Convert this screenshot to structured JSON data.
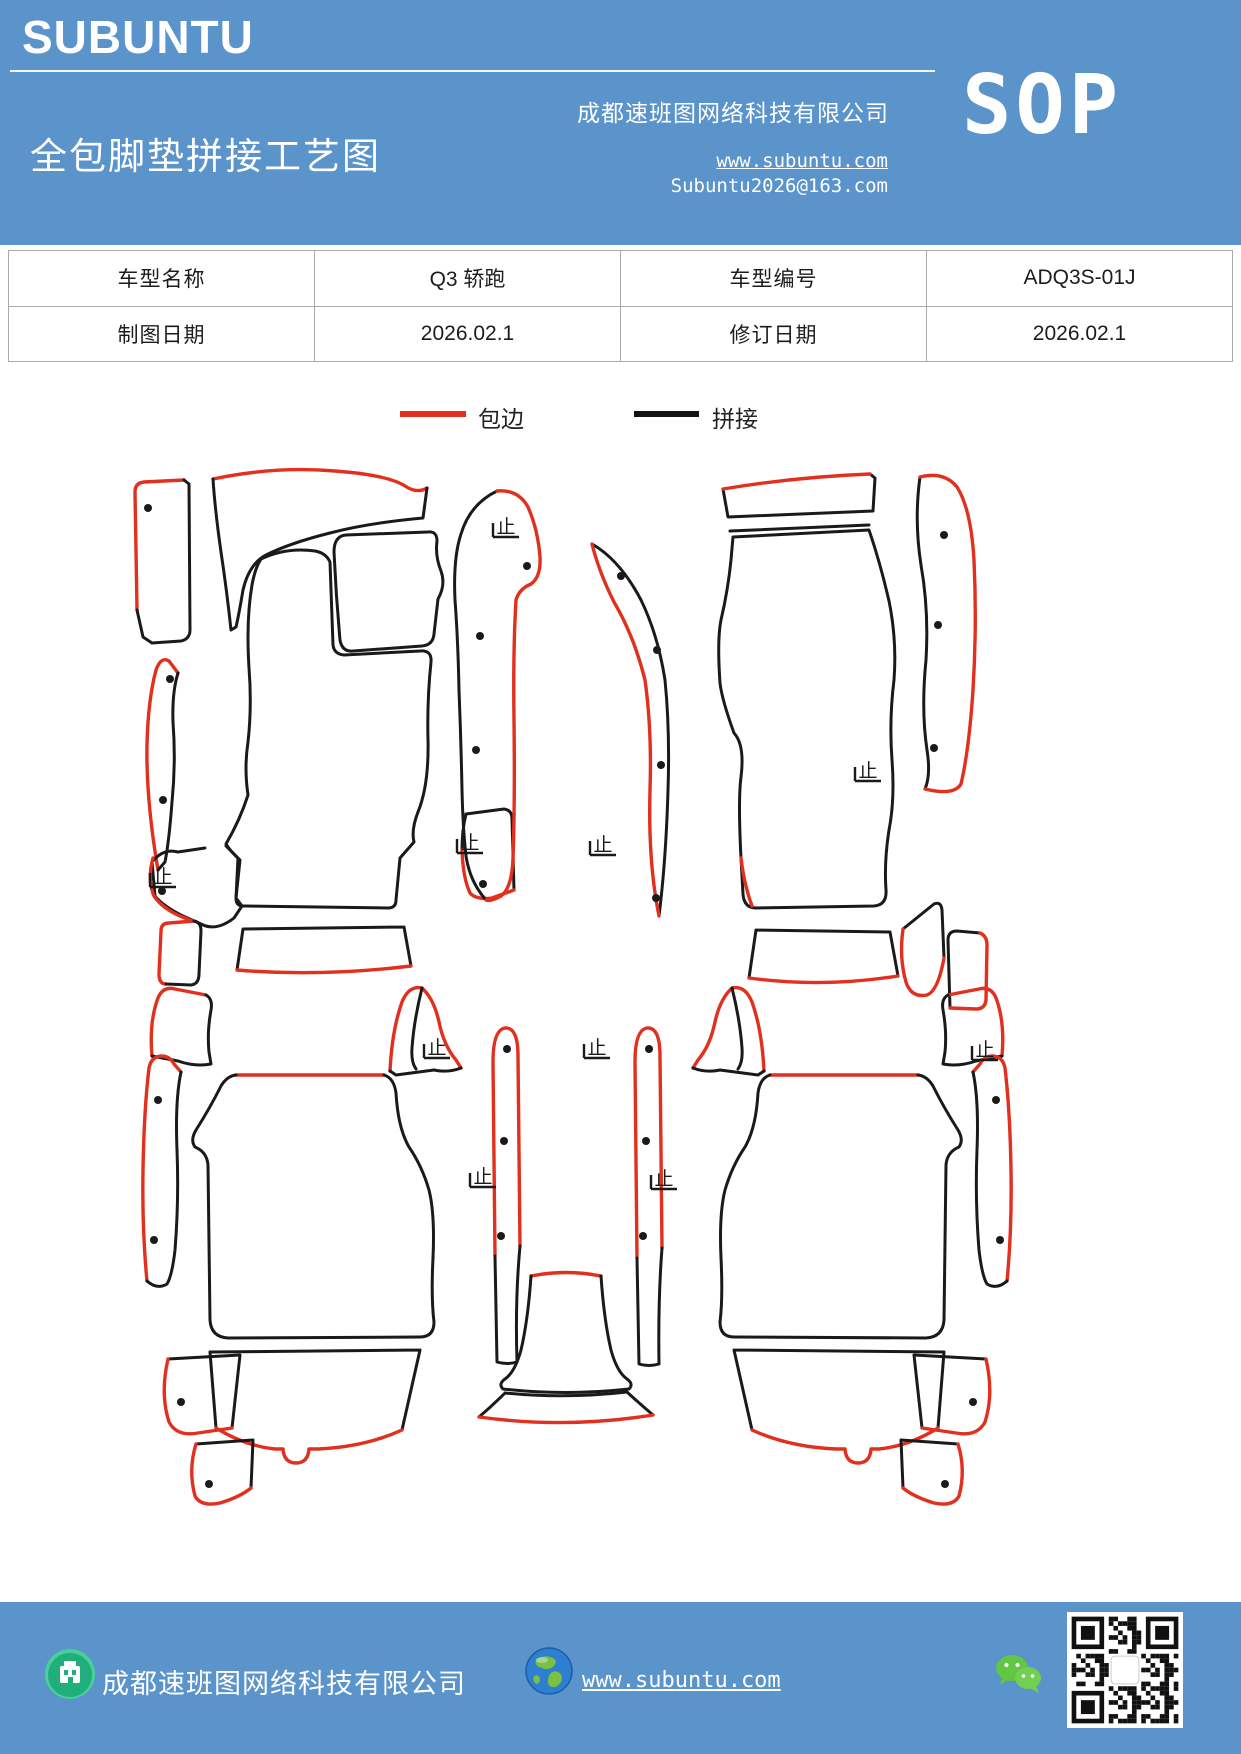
{
  "header": {
    "logo": "SUBUNTU",
    "title": "全包脚垫拼接工艺图",
    "company": "成都速班图网络科技有限公司",
    "sop_label": "SOP",
    "url": "www.subuntu.com",
    "email": "Subuntu2026@163.com"
  },
  "info_table": {
    "rows": [
      [
        "车型名称",
        "Q3  轿跑",
        "车型编号",
        "ADQ3S-01J"
      ],
      [
        "制图日期",
        "2026.02.1",
        "修订日期",
        "2026.02.1"
      ]
    ]
  },
  "legend": {
    "items": [
      {
        "label": "包边",
        "color": "#e2301f"
      },
      {
        "label": "拼接",
        "color": "#141414"
      }
    ]
  },
  "diagram": {
    "red": "#e2301f",
    "black": "#1a1a1a",
    "stop_glyph": "止",
    "paths": [
      {
        "c": "r",
        "d": "M137,610 L135,492 Q135,483 144,482 L184,480"
      },
      {
        "c": "k",
        "d": "M184,480 L189,484 L190,630 Q190,639 181,641 L152,643 L143,637 L137,610"
      },
      {
        "c": "r",
        "d": "M213,479 Q275,466 335,471 Q388,475 405,486 Q417,494 427,488"
      },
      {
        "c": "k",
        "d": "M427,488 L423,518 Q368,523 330,533 Q290,543 266,555 Q249,564 243,590 Q239,614 236,627 L231,630 Q227,592 221,552 Q215,510 213,479"
      },
      {
        "c": "k",
        "d": "M334,552 Q334,536 346,535 L428,532 Q437,531 437,541 Q435,556 441,571 Q446,585 438,599 L434,634 Q433,645 422,646 L353,651 Q342,652 340,640 Q336,596 334,552"
      },
      {
        "c": "k",
        "d": "M261,559 Q286,547 315,551 Q326,553 330,562 L333,645 Q334,654 344,655 L420,651 Q432,650 431,662 Q427,700 428,740 Q429,785 418,812 Q411,830 414,842 L400,858 L396,900 Q396,908 388,908 L243,906 Q236,906 236,898 L240,860 Q231,852 226,844 Q240,820 248,795 Q244,768 248,742 Q252,706 249,668 Q246,620 252,585 Q255,568 261,559"
      },
      {
        "c": "r",
        "d": "M158,870 Q146,800 147,745 Q148,700 156,670 Q161,656 169,661 L178,673"
      },
      {
        "c": "k",
        "d": "M178,673 Q172,692 173,722 Q176,762 172,802 Q169,842 165,862 L158,870"
      },
      {
        "c": "k",
        "d": "M226,846 L238,858 L236,898 L242,906 L234,918 Q216,932 201,924 L183,916 Q163,906 155,896 L152,862 Q163,848 178,852 L205,848"
      },
      {
        "c": "r",
        "d": "M153,858 Q147,880 154,896 Q162,908 180,916 L192,921"
      },
      {
        "c": "r",
        "d": "M166,984 Q159,984 159,974 L161,931 Q161,923 169,923 L194,921"
      },
      {
        "c": "k",
        "d": "M194,921 Q201,922 201,931 L199,974 Q199,984 191,985 L166,984"
      },
      {
        "c": "k",
        "d": "M243,929 L404,927 M243,929 L237,970 M404,927 L411,966"
      },
      {
        "c": "r",
        "d": "M237,970 Q320,977 411,966"
      },
      {
        "c": "k",
        "d": "M466,814 L504,809 Q512,810 512,819 L514,890 M466,814 Q462,830 462,850"
      },
      {
        "c": "r",
        "d": "M462,850 Q463,878 470,893 Q476,900 492,898 L514,890"
      },
      {
        "c": "k",
        "d": "M497,491 Q470,504 461,534 Q453,558 455,600 Q458,640 459,690 Q461,740 462,790 Q463,830 466,856 Q470,882 486,900"
      },
      {
        "c": "r",
        "d": "M497,491 Q518,489 528,507 Q538,530 540,557 Q541,577 531,584 Q519,589 516,600 Q513,650 514,720 Q515,800 513,858 Q512,888 501,896 Q490,902 486,900"
      },
      {
        "c": "k",
        "d": "M870,474 L875,478 L873,511 L728,517 L723,489"
      },
      {
        "c": "r",
        "d": "M723,489 Q795,477 870,474"
      },
      {
        "c": "k",
        "d": "M730,531 L869,525"
      },
      {
        "c": "k",
        "d": "M733,537 L869,530 Q880,562 889,601 Q897,640 894,680 Q889,720 892,760 Q895,800 889,830 Q884,862 886,890 Q887,905 874,906 L756,908 Q744,908 743,894 L741,858 Q738,800 741,777 Q745,745 734,733 Q722,700 720,683 Q717,640 721,620 Q728,590 731,560 L733,537"
      },
      {
        "c": "r",
        "d": "M741,858 Q744,884 752,906"
      },
      {
        "c": "k",
        "d": "M592,544 Q620,560 641,600 Q658,635 665,680 Q670,730 668,790 Q666,860 659,916"
      },
      {
        "c": "r",
        "d": "M592,544 Q599,572 614,602 Q634,636 645,680 Q652,730 650,790 Q648,862 659,916"
      },
      {
        "c": "k",
        "d": "M756,930 L890,932 M756,930 L749,978 M890,932 L898,976"
      },
      {
        "c": "r",
        "d": "M749,978 Q823,988 898,976"
      },
      {
        "c": "k",
        "d": "M903,929 L934,904 Q941,901 942,910 L944,958"
      },
      {
        "c": "r",
        "d": "M903,929 Q899,958 906,982 Q911,998 927,995 Q938,991 944,958"
      },
      {
        "c": "k",
        "d": "M950,1008 L948,940 Q948,931 957,931 L980,933"
      },
      {
        "c": "r",
        "d": "M980,933 Q987,936 987,945 L986,1000 Q985,1009 976,1009 L950,1008"
      },
      {
        "c": "k",
        "d": "M920,477 Q914,520 921,565 Q929,610 926,660 Q921,710 927,750 Q931,775 925,789"
      },
      {
        "c": "r",
        "d": "M920,477 Q944,471 957,487 Q971,509 974,560 Q977,625 973,690 Q969,750 961,784 Q954,796 925,789"
      },
      {
        "c": "r",
        "d": "M495,1256 L493,1062 Q493,1030 505,1028 Q518,1027 518,1056 L520,1246"
      },
      {
        "c": "k",
        "d": "M495,1256 Q496,1310 497,1362 Q507,1365 517,1362 Q515,1300 520,1246"
      },
      {
        "c": "r",
        "d": "M637,1258 L635,1062 Q635,1030 647,1028 Q660,1027 660,1056 L662,1248"
      },
      {
        "c": "k",
        "d": "M637,1258 Q638,1310 639,1364 Q649,1367 659,1364 Q658,1300 662,1248"
      },
      {
        "c": "r",
        "d": "M531,1276 Q566,1269 601,1276"
      },
      {
        "c": "k",
        "d": "M531,1276 Q528,1320 521,1350 Q515,1372 505,1379 Q498,1384 503,1389 Q565,1396 629,1389 Q634,1384 627,1379 Q617,1372 611,1350 Q604,1320 601,1276"
      },
      {
        "c": "k",
        "d": "M505,1393 Q565,1399 627,1392 M505,1393 Q492,1406 479,1417 M627,1392 Q640,1404 653,1415"
      },
      {
        "c": "r",
        "d": "M479,1417 Q566,1429 653,1415"
      },
      {
        "c": "r",
        "d": "M152,1056 Q149,1022 158,998 Q163,986 175,989 L206,995"
      },
      {
        "c": "k",
        "d": "M206,995 Q213,999 211,1010 Q207,1032 209,1052 L211,1064 Q195,1067 178,1061 L152,1056"
      },
      {
        "c": "r",
        "d": "M147,1281 Q142,1230 143,1170 Q144,1110 149,1068 Q151,1057 161,1056 Q170,1056 174,1064 L181,1072"
      },
      {
        "c": "k",
        "d": "M181,1072 Q175,1100 177,1150 Q179,1200 175,1250 Q172,1276 167,1284 Q157,1290 147,1281"
      },
      {
        "c": "r",
        "d": "M236,1075 L384,1075"
      },
      {
        "c": "k",
        "d": "M236,1075 Q227,1076 221,1086 Q210,1108 196,1130 Q190,1140 195,1147 Q207,1152 208,1165 L210,1320 Q211,1337 228,1338 L420,1337 Q434,1337 434,1322 Q431,1298 433,1258 Q435,1214 429,1190 Q422,1166 409,1147 Q398,1128 396,1093 Q394,1078 384,1075"
      },
      {
        "c": "r",
        "d": "M390,1071 Q392,1030 402,1002 Q409,985 422,988 Q434,999 439,1022 Q444,1046 456,1060 L461,1068"
      },
      {
        "c": "k",
        "d": "M461,1068 Q448,1073 434,1070 L396,1075 L390,1071 M422,988 Q414,1020 412,1048 Q411,1062 416,1069"
      },
      {
        "c": "k",
        "d": "M210,1352 L420,1350 M210,1352 L216,1428 M420,1350 L402,1430"
      },
      {
        "c": "r",
        "d": "M216,1428 Q245,1446 275,1449 L283,1449 Q284,1463 296,1463 Q308,1463 309,1449 L318,1449 Q365,1447 402,1430"
      },
      {
        "c": "k",
        "d": "M168,1359 L240,1355 L232,1428"
      },
      {
        "c": "r",
        "d": "M168,1359 Q160,1394 169,1422 Q177,1437 198,1433 L232,1428"
      },
      {
        "c": "k",
        "d": "M196,1444 L253,1440 L251,1488"
      },
      {
        "c": "r",
        "d": "M196,1444 Q188,1470 195,1496 Q201,1507 220,1503 Q240,1497 251,1488"
      },
      {
        "c": "r",
        "d": "M1002,1056 Q1005,1022 996,998 Q991,986 979,989 L948,995"
      },
      {
        "c": "k",
        "d": "M948,995 Q941,999 943,1010 Q947,1032 945,1052 L943,1064 Q959,1067 976,1061 L1002,1056"
      },
      {
        "c": "r",
        "d": "M1007,1281 Q1012,1230 1011,1170 Q1010,1110 1005,1068 Q1003,1057 993,1056 Q984,1056 980,1064 L973,1072"
      },
      {
        "c": "k",
        "d": "M973,1072 Q979,1100 977,1150 Q975,1200 979,1250 Q982,1276 987,1284 Q997,1290 1007,1281"
      },
      {
        "c": "r",
        "d": "M918,1075 L770,1075"
      },
      {
        "c": "k",
        "d": "M918,1075 Q927,1076 933,1086 Q944,1108 958,1130 Q964,1140 959,1147 Q947,1152 946,1165 L944,1320 Q943,1337 926,1338 L734,1337 Q720,1337 720,1322 Q723,1298 721,1258 Q719,1214 725,1190 Q732,1166 745,1147 Q756,1128 758,1093 Q760,1078 770,1075"
      },
      {
        "c": "r",
        "d": "M764,1071 Q762,1030 752,1002 Q745,985 732,988 Q720,999 715,1022 Q710,1046 698,1060 L693,1068"
      },
      {
        "c": "k",
        "d": "M693,1068 Q706,1073 720,1070 L758,1075 L764,1071 M732,988 Q740,1020 742,1048 Q743,1062 738,1069"
      },
      {
        "c": "k",
        "d": "M944,1352 L734,1350 M944,1352 L938,1428 M734,1350 L752,1430"
      },
      {
        "c": "r",
        "d": "M938,1428 Q909,1446 879,1449 L871,1449 Q870,1463 858,1463 Q846,1463 845,1449 L836,1449 Q789,1447 752,1430"
      },
      {
        "c": "k",
        "d": "M986,1359 L914,1355 L922,1428"
      },
      {
        "c": "r",
        "d": "M986,1359 Q994,1394 985,1422 Q977,1437 956,1433 L922,1428"
      },
      {
        "c": "k",
        "d": "M958,1444 L901,1440 L903,1488"
      },
      {
        "c": "r",
        "d": "M958,1444 Q966,1470 959,1496 Q953,1507 934,1503 Q914,1497 903,1488"
      }
    ],
    "dots": [
      [
        148,
        508
      ],
      [
        170,
        679
      ],
      [
        163,
        800
      ],
      [
        162,
        891
      ],
      [
        480,
        636
      ],
      [
        476,
        750
      ],
      [
        483,
        884
      ],
      [
        527,
        566
      ],
      [
        621,
        576
      ],
      [
        657,
        650
      ],
      [
        661,
        765
      ],
      [
        656,
        898
      ],
      [
        944,
        535
      ],
      [
        938,
        625
      ],
      [
        934,
        748
      ],
      [
        507,
        1049
      ],
      [
        504,
        1141
      ],
      [
        501,
        1236
      ],
      [
        649,
        1049
      ],
      [
        646,
        1141
      ],
      [
        643,
        1236
      ],
      [
        158,
        1100
      ],
      [
        154,
        1240
      ],
      [
        181,
        1402
      ],
      [
        209,
        1484
      ],
      [
        996,
        1100
      ],
      [
        1000,
        1240
      ],
      [
        973,
        1402
      ],
      [
        945,
        1484
      ]
    ],
    "stops": [
      [
        506,
        533
      ],
      [
        470,
        849
      ],
      [
        163,
        883
      ],
      [
        603,
        851
      ],
      [
        868,
        777
      ],
      [
        437,
        1054
      ],
      [
        597,
        1054
      ],
      [
        985,
        1056
      ],
      [
        483,
        1183
      ],
      [
        664,
        1185
      ]
    ]
  },
  "footer": {
    "company": "成都速班图网络科技有限公司",
    "url": "www.subuntu.com",
    "building_icon_color": "#2ebd85",
    "wechat_icon_color": "#62c543"
  }
}
